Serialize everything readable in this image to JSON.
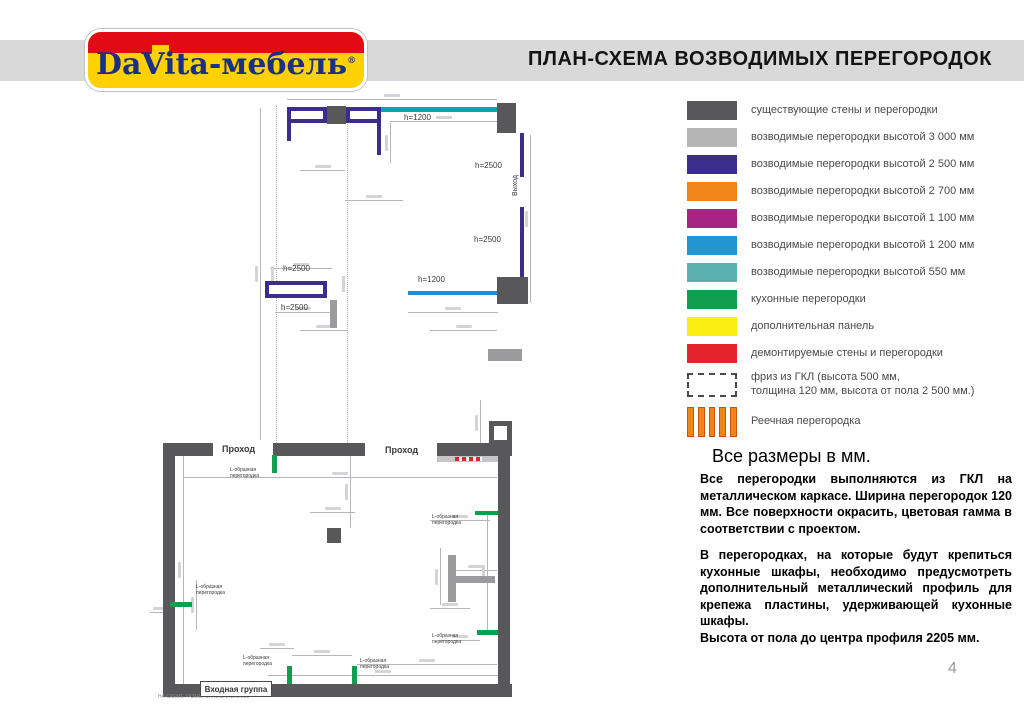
{
  "header": {
    "title": "ПЛАН-СХЕМА ВОЗВОДИМЫХ ПЕРЕГОРОДОК",
    "logo": {
      "brand": "DaVita",
      "dash": "-",
      "suffix": "мебель",
      "reg": "®"
    }
  },
  "legend": {
    "items": [
      {
        "label": "существующие стены и перегородки",
        "color": "#58585a",
        "type": "solid"
      },
      {
        "label": "возводимые перегородки высотой 3 000 мм",
        "color": "#b5b5b5",
        "type": "solid"
      },
      {
        "label": "возводимые перегородки высотой 2 500 мм",
        "color": "#3b2d8c",
        "type": "solid"
      },
      {
        "label": "возводимые перегородки высотой 2 700 мм",
        "color": "#f08519",
        "type": "solid"
      },
      {
        "label": "возводимые перегородки высотой 1 100 мм",
        "color": "#a62583",
        "type": "solid"
      },
      {
        "label": "возводимые перегородки высотой 1 200 мм",
        "color": "#2196d0",
        "type": "solid"
      },
      {
        "label": "возводимые перегородки высотой 550 мм",
        "color": "#5ab0ac",
        "type": "solid"
      },
      {
        "label": "кухонные перегородки",
        "color": "#0f9f4f",
        "type": "solid"
      },
      {
        "label": "дополнительная панель",
        "color": "#f9ee10",
        "type": "solid"
      },
      {
        "label": "демонтируемые стены и перегородки",
        "color": "#e4232b",
        "type": "solid"
      },
      {
        "label": "фриз из ГКЛ (высота 500 мм,\nтолщина 120 мм, высота от пола 2 500 мм.)",
        "color": "#ffffff",
        "type": "dashed"
      },
      {
        "label": "Реечная перегородка",
        "color": "#f08519",
        "type": "striped"
      }
    ]
  },
  "notes": {
    "heading": "Все размеры в мм.",
    "para1": "Все перегородки выполняются из ГКЛ на металлическом каркасе. Ширина перегородок 120 мм. Все поверхности окрасить, цветовая гамма в соответствии с проектом.",
    "para2": "В перегородках, на которые будут крепиться кухонные шкафы, необходимо предусмотреть дополнительный металлический профиль для крепежа пластины, удерживающей кухонные шкафы.",
    "para3": "Высота от пола до центра профиля 2205 мм."
  },
  "page_number": "4",
  "plan": {
    "entrance_label": "Входная группа",
    "palette": {
      "dark": "#58585a",
      "medium": "#9b9b9d",
      "light": "#c6c6c8",
      "purple": "#3b2d8c",
      "teal": "#0ba3b2",
      "blue": "#1e8fd5",
      "green": "#0f9f4f",
      "red": "#e4232b",
      "dim": "#b6b6ba"
    },
    "dims": [
      {
        "o": "h",
        "x": 287,
        "y": 99,
        "l": 210
      },
      {
        "o": "h",
        "x": 300,
        "y": 170,
        "l": 45
      },
      {
        "o": "h",
        "x": 345,
        "y": 200,
        "l": 58
      },
      {
        "o": "h",
        "x": 390,
        "y": 121,
        "l": 107
      },
      {
        "o": "h",
        "x": 270,
        "y": 268,
        "l": 62
      },
      {
        "o": "h",
        "x": 275,
        "y": 312,
        "l": 55
      },
      {
        "o": "h",
        "x": 300,
        "y": 330,
        "l": 48
      },
      {
        "o": "h",
        "x": 408,
        "y": 312,
        "l": 90
      },
      {
        "o": "h",
        "x": 430,
        "y": 330,
        "l": 67
      },
      {
        "o": "h",
        "x": 183,
        "y": 477,
        "l": 314
      },
      {
        "o": "h",
        "x": 430,
        "y": 520,
        "l": 60
      },
      {
        "o": "h",
        "x": 310,
        "y": 512,
        "l": 45
      },
      {
        "o": "h",
        "x": 268,
        "y": 675,
        "l": 230
      },
      {
        "o": "h",
        "x": 292,
        "y": 655,
        "l": 60
      },
      {
        "o": "h",
        "x": 260,
        "y": 648,
        "l": 34
      },
      {
        "o": "h",
        "x": 357,
        "y": 664,
        "l": 140
      },
      {
        "o": "h",
        "x": 455,
        "y": 570,
        "l": 42
      },
      {
        "o": "h",
        "x": 430,
        "y": 608,
        "l": 40
      },
      {
        "o": "h",
        "x": 150,
        "y": 612,
        "l": 22
      },
      {
        "o": "h",
        "x": 440,
        "y": 640,
        "l": 40
      },
      {
        "o": "v",
        "x": 260,
        "y": 108,
        "l": 332
      },
      {
        "o": "v",
        "x": 276,
        "y": 105,
        "l": 338,
        "dotted": true
      },
      {
        "o": "v",
        "x": 347,
        "y": 124,
        "l": 319,
        "dotted": true
      },
      {
        "o": "v",
        "x": 390,
        "y": 123,
        "l": 40
      },
      {
        "o": "v",
        "x": 530,
        "y": 135,
        "l": 168
      },
      {
        "o": "v",
        "x": 183,
        "y": 456,
        "l": 228
      },
      {
        "o": "v",
        "x": 350,
        "y": 456,
        "l": 72
      },
      {
        "o": "v",
        "x": 487,
        "y": 515,
        "l": 115
      },
      {
        "o": "v",
        "x": 196,
        "y": 580,
        "l": 50
      },
      {
        "o": "v",
        "x": 440,
        "y": 548,
        "l": 57
      },
      {
        "o": "v",
        "x": 480,
        "y": 400,
        "l": 45
      }
    ],
    "shapes": [
      {
        "name": "existing-wall-block",
        "x": 327,
        "y": 106,
        "w": 19,
        "h": 18,
        "fill": "dark"
      },
      {
        "name": "existing-wall-block",
        "x": 497,
        "y": 103,
        "w": 19,
        "h": 30,
        "fill": "dark"
      },
      {
        "name": "existing-wall-block",
        "x": 497,
        "y": 277,
        "w": 31,
        "h": 27,
        "fill": "dark"
      },
      {
        "name": "existing-wall-stub",
        "x": 330,
        "y": 300,
        "w": 7,
        "h": 28,
        "fill": "medium"
      },
      {
        "name": "existing-wall-bar",
        "x": 488,
        "y": 349,
        "w": 34,
        "h": 12,
        "fill": "medium"
      },
      {
        "name": "room-wall-left",
        "x": 163,
        "y": 443,
        "w": 12,
        "h": 254,
        "fill": "dark"
      },
      {
        "name": "room-wall-top",
        "x": 175,
        "y": 443,
        "w": 38,
        "h": 13,
        "fill": "dark"
      },
      {
        "name": "room-wall-top",
        "x": 273,
        "y": 443,
        "w": 92,
        "h": 13,
        "fill": "dark"
      },
      {
        "name": "room-wall-top",
        "x": 437,
        "y": 443,
        "w": 75,
        "h": 13,
        "fill": "dark"
      },
      {
        "name": "room-wall-bottom",
        "x": 163,
        "y": 684,
        "w": 349,
        "h": 13,
        "fill": "dark"
      },
      {
        "name": "room-wall-right",
        "x": 498,
        "y": 443,
        "w": 12,
        "h": 241,
        "fill": "dark"
      },
      {
        "name": "wall-inner-strip",
        "x": 437,
        "y": 456,
        "w": 61,
        "h": 6,
        "fill": "light"
      },
      {
        "name": "demolished-wall-segment",
        "x": 455,
        "y": 457,
        "w": 27,
        "h": 4,
        "type": "dashes",
        "fill": "red"
      },
      {
        "name": "right-bay",
        "x": 489,
        "y": 421,
        "w": 23,
        "h": 24,
        "type": "outline",
        "stroke": "dark",
        "thick": 5
      },
      {
        "name": "column",
        "x": 327,
        "y": 528,
        "w": 14,
        "h": 15,
        "fill": "dark"
      },
      {
        "name": "t-partition-vertical",
        "x": 448,
        "y": 555,
        "w": 8,
        "h": 47,
        "fill": "medium"
      },
      {
        "name": "t-partition-horizontal",
        "x": 456,
        "y": 576,
        "w": 39,
        "h": 7,
        "fill": "medium"
      },
      {
        "name": "partition-2500-outline",
        "x": 287,
        "y": 107,
        "w": 40,
        "h": 16,
        "type": "outline",
        "stroke": "purple",
        "thick": 4
      },
      {
        "name": "partition-2500-outline",
        "x": 346,
        "y": 107,
        "w": 35,
        "h": 16,
        "type": "outline",
        "stroke": "purple",
        "thick": 4
      },
      {
        "name": "partition-2500",
        "x": 287,
        "y": 123,
        "w": 4,
        "h": 18,
        "fill": "purple"
      },
      {
        "name": "partition-2500",
        "x": 377,
        "y": 123,
        "w": 4,
        "h": 32,
        "fill": "purple"
      },
      {
        "name": "partition-2500",
        "x": 520,
        "y": 133,
        "w": 4,
        "h": 44,
        "fill": "purple"
      },
      {
        "name": "partition-2500",
        "x": 520,
        "y": 207,
        "w": 4,
        "h": 70,
        "fill": "purple"
      },
      {
        "name": "partition-2500-outline",
        "x": 265,
        "y": 281,
        "w": 62,
        "h": 17,
        "type": "outline",
        "stroke": "purple",
        "thick": 4
      },
      {
        "name": "partition-1200",
        "x": 381,
        "y": 107,
        "w": 116,
        "h": 5,
        "fill": "teal"
      },
      {
        "name": "partition-1200",
        "x": 408,
        "y": 291,
        "w": 89,
        "h": 4,
        "fill": "blue"
      },
      {
        "name": "kitchen-partition",
        "x": 272,
        "y": 455,
        "w": 5,
        "h": 18,
        "fill": "green"
      },
      {
        "name": "kitchen-partition",
        "x": 475,
        "y": 511,
        "w": 23,
        "h": 4,
        "fill": "green"
      },
      {
        "name": "kitchen-partition",
        "x": 170,
        "y": 602,
        "w": 22,
        "h": 5,
        "fill": "green"
      },
      {
        "name": "kitchen-partition",
        "x": 477,
        "y": 630,
        "w": 21,
        "h": 5,
        "fill": "green"
      },
      {
        "name": "kitchen-partition",
        "x": 287,
        "y": 666,
        "w": 5,
        "h": 18,
        "fill": "green"
      },
      {
        "name": "kitchen-partition",
        "x": 352,
        "y": 666,
        "w": 5,
        "h": 18,
        "fill": "green"
      }
    ],
    "labels": [
      {
        "t": "h=1200",
        "x": 404,
        "y": 113,
        "s": 8
      },
      {
        "t": "h=2500",
        "x": 475,
        "y": 161,
        "s": 8
      },
      {
        "t": "h=2500",
        "x": 474,
        "y": 235,
        "s": 8
      },
      {
        "t": "h=2500",
        "x": 283,
        "y": 264,
        "s": 8
      },
      {
        "t": "h=2500",
        "x": 281,
        "y": 303,
        "s": 8
      },
      {
        "t": "h=1200",
        "x": 418,
        "y": 275,
        "s": 8
      },
      {
        "t": "Выход",
        "x": 512,
        "y": 175,
        "s": 7,
        "rot": true
      },
      {
        "t": "Проход",
        "x": 222,
        "y": 444,
        "s": 9,
        "b": true
      },
      {
        "t": "Проход",
        "x": 385,
        "y": 445,
        "s": 9,
        "b": true
      },
      {
        "t": "L-образная\nперегородка",
        "x": 230,
        "y": 468,
        "s": 5
      },
      {
        "t": "L-образная\nперегородка",
        "x": 432,
        "y": 515,
        "s": 5
      },
      {
        "t": "L-образная\nперегородка",
        "x": 196,
        "y": 585,
        "s": 5
      },
      {
        "t": "L-образная\nперегородка",
        "x": 432,
        "y": 634,
        "s": 5
      },
      {
        "t": "L-образная\nперегородка",
        "x": 243,
        "y": 656,
        "s": 5
      },
      {
        "t": "L-образная\nперегородка",
        "x": 360,
        "y": 659,
        "s": 5
      },
      {
        "t": "НА СХЕМЕ РАЗМЕРЫ УКАЗАНЫ В ММ",
        "x": 158,
        "y": 695,
        "s": 5,
        "c": "#8a8a8a"
      }
    ]
  }
}
